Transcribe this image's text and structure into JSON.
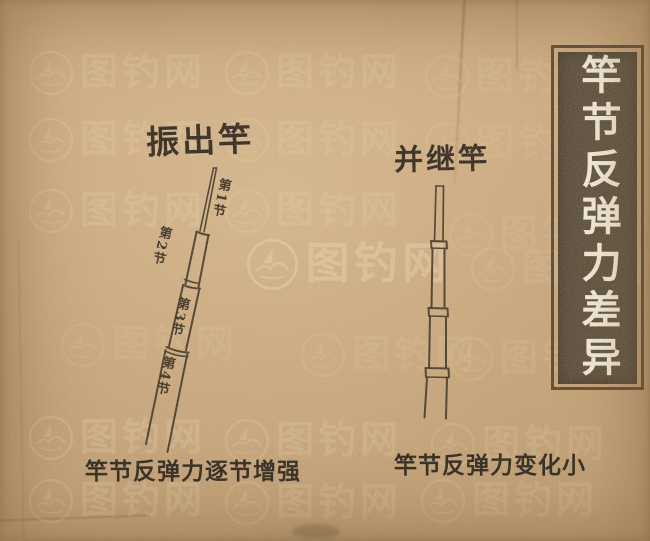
{
  "title_banner": {
    "text": "竿节反弹力差异"
  },
  "left_rod": {
    "name": "振出竿",
    "section_labels": [
      "第1节",
      "第2节",
      "第3节",
      "第4节"
    ],
    "caption": "竿节反弹力逐节增强"
  },
  "right_rod": {
    "name": "并继竿",
    "caption": "竿节反弹力变化小"
  },
  "watermark": {
    "text": "图钓网",
    "logo": "boat-in-circle-icon"
  },
  "colors": {
    "paper": "#c9a67a",
    "banner_bg": "#4c4030",
    "banner_border": "#4a3a26",
    "banner_text": "#f7f2e4",
    "ink": "#2e2518",
    "caption_ink": "#17130e",
    "watermark": "#f0e1ba"
  }
}
